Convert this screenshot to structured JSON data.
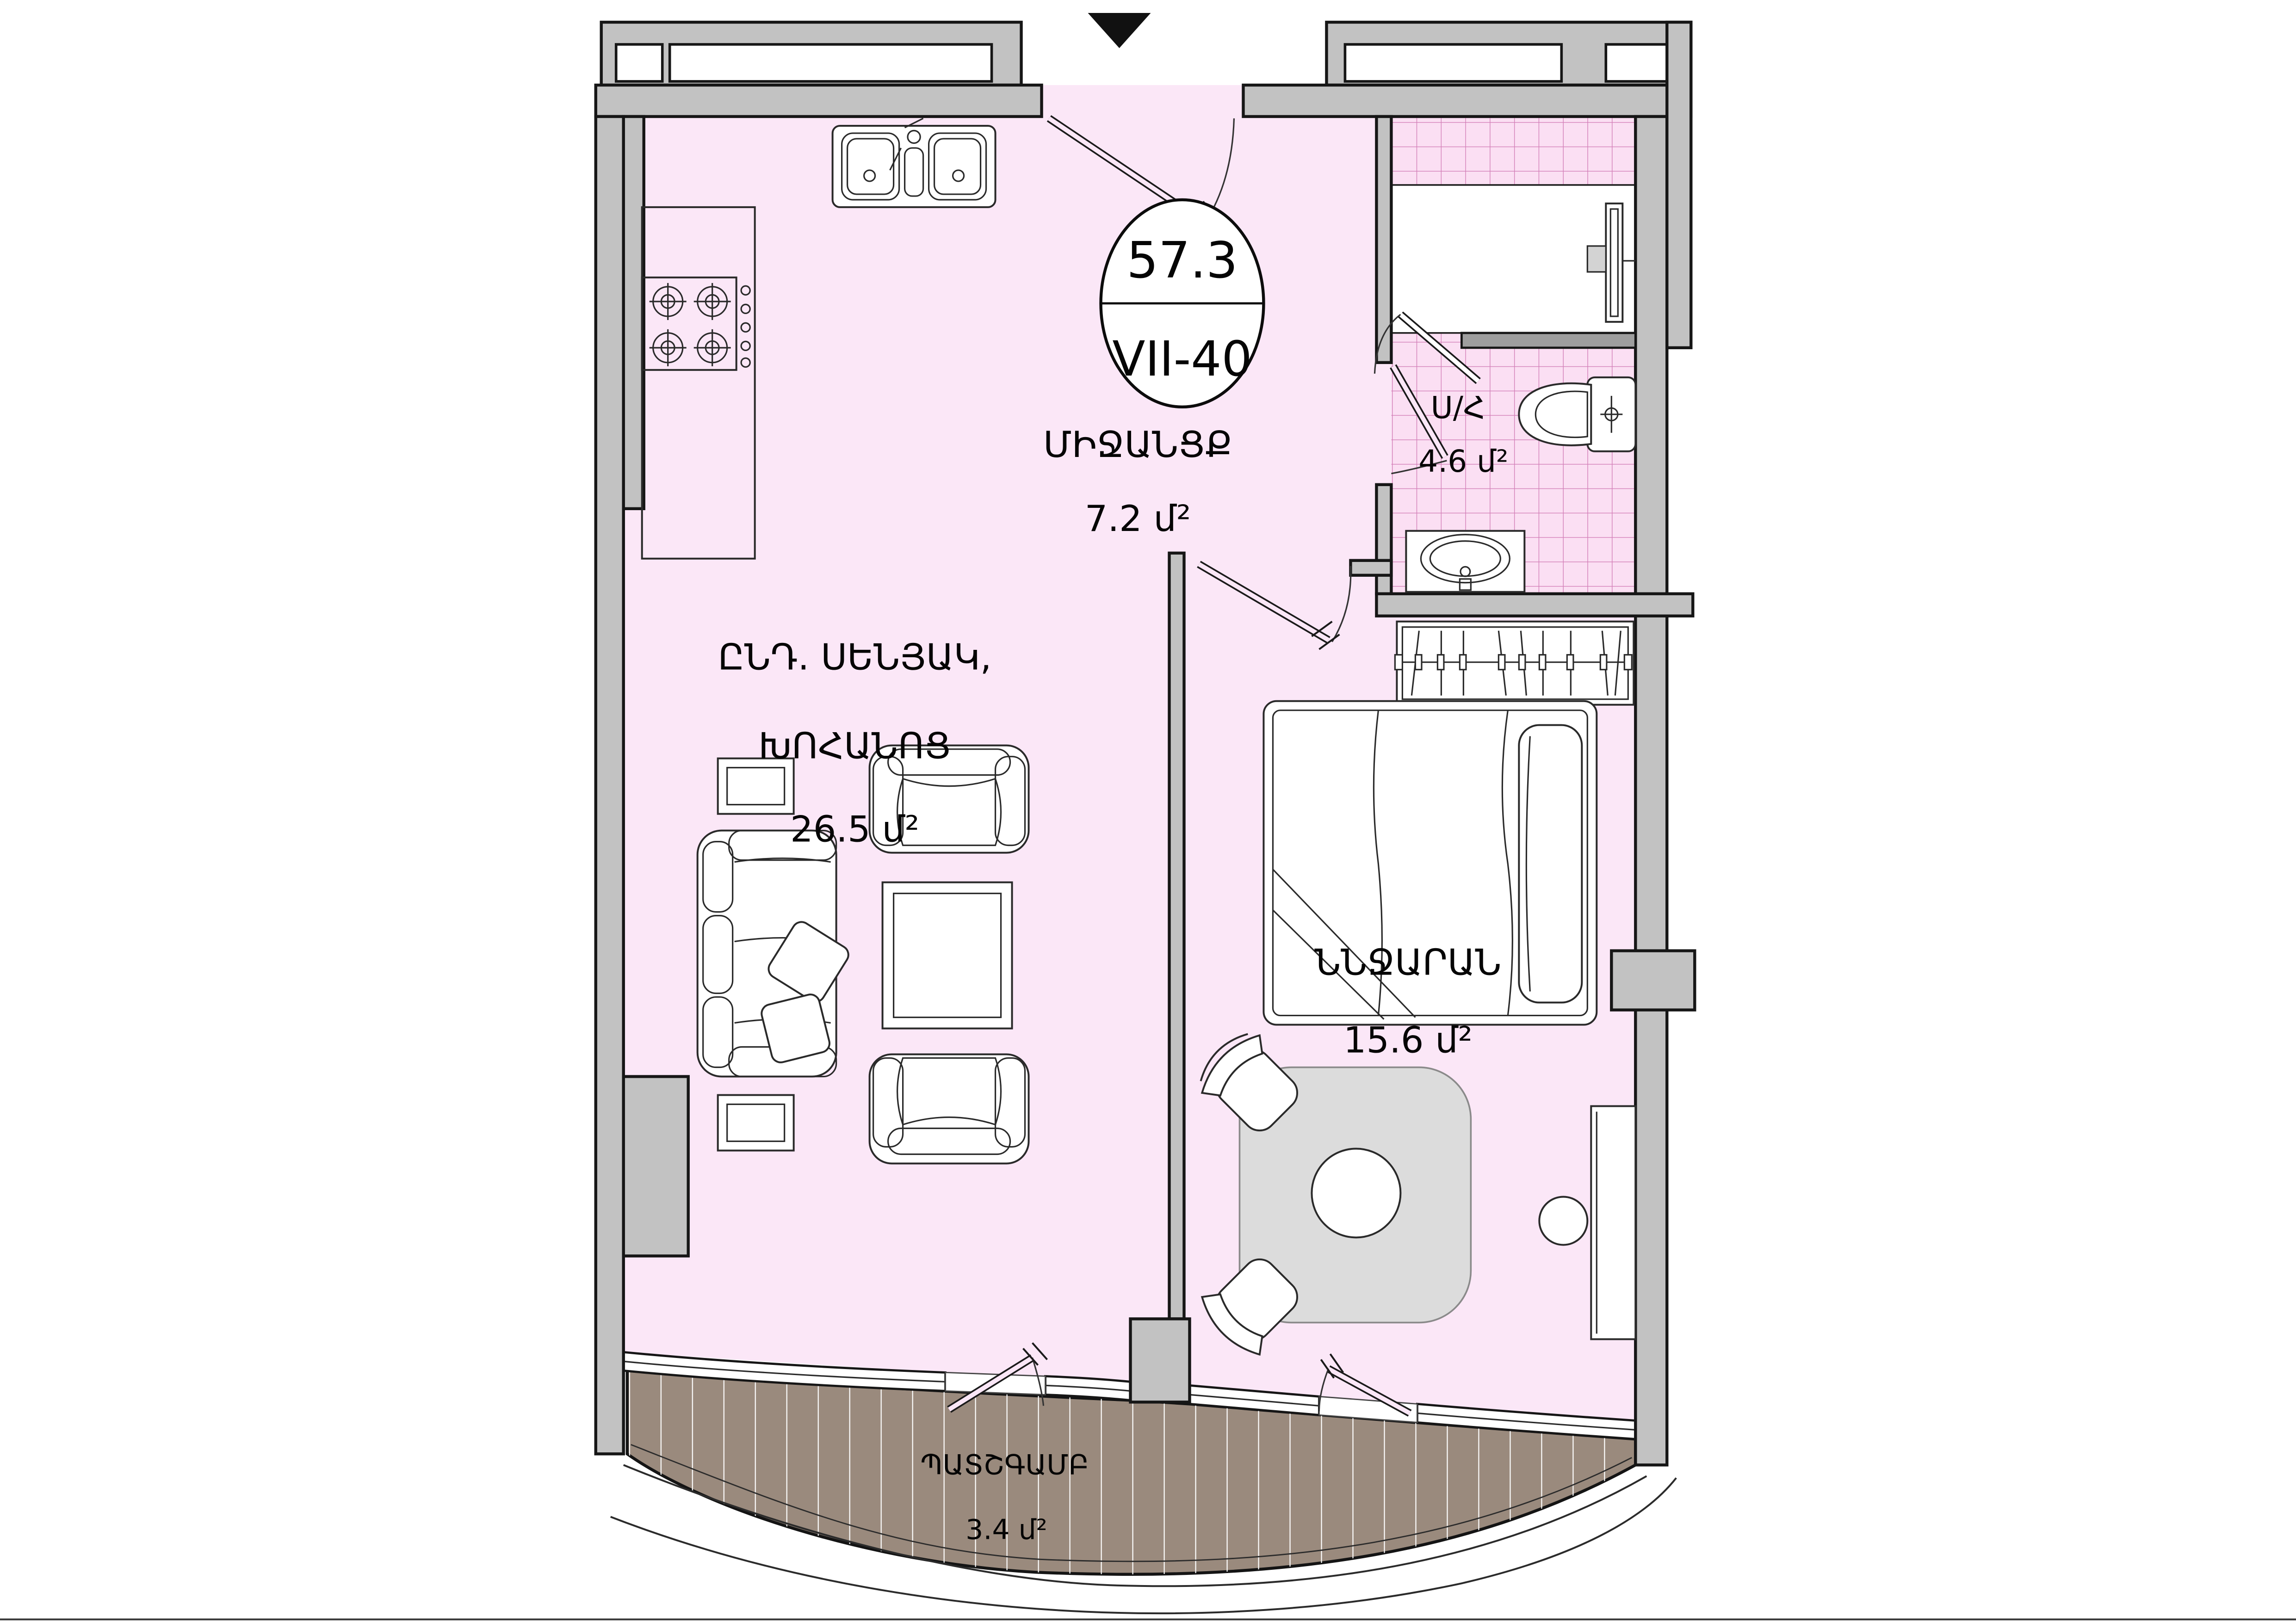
{
  "plan": {
    "badge": {
      "area": "57.3",
      "unit": "VII-40"
    },
    "rooms": {
      "corridor": {
        "name": "ՄԻՋԱՆՑՔ",
        "area": "7.2 մ²"
      },
      "bathroom": {
        "name": "Ս/Հ",
        "area": "4.6 մ²"
      },
      "living": {
        "name1": "ԸՆԴ. ՍԵՆՅԱԿ,",
        "name2": "ԽՈՀԱՆՈՑ",
        "area": "26.5 մ²"
      },
      "bedroom": {
        "name": "ՆՆՋԱՐԱՆ",
        "area": "15.6 մ²"
      },
      "balcony": {
        "name": "ՊԱՏՇԳԱՄԲ",
        "area": "3.4 մ²"
      }
    },
    "colors": {
      "floor": "#fbe7f7",
      "tile": "#fbdff3",
      "tile_grid": "#d37fb8",
      "wall": "#c2c2c2",
      "balcony_deck": "#9a8a7d",
      "entrance_marker": "#111111"
    },
    "icons": {
      "entrance_marker": "triangle-down-icon"
    }
  }
}
